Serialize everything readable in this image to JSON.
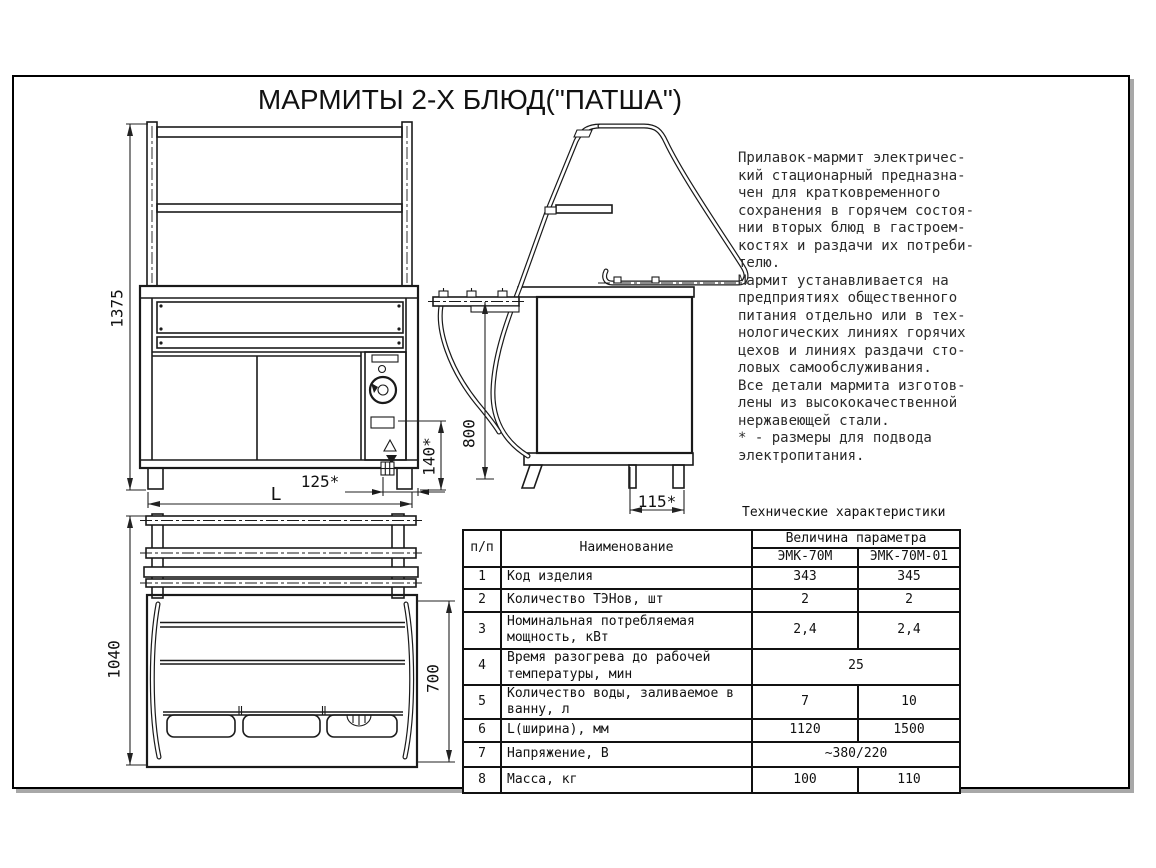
{
  "page": {
    "title": "МАРМИТЫ 2-Х БЛЮД(\"ПАТША\")"
  },
  "colors": {
    "line": "#1a1a1a",
    "frame_shadow": "#a8a8a8",
    "background": "#ffffff"
  },
  "description": {
    "lines": [
      "Прилавок-мармит электричес-",
      "кий стационарный предназна-",
      "чен  для  кратковременного",
      "сохранения в горячем состоя-",
      "нии вторых блюд  в гастроем-",
      "костях и раздачи их  потреби-",
      "телю.",
      "Мармит устанавливается  на",
      "предприятиях общественного",
      "питания отдельно или  в  тех-",
      "нологических линиях горячих",
      "цехов  и  линиях  раздачи сто-",
      "ловых самообслуживания.",
      "Все детали  мармита  изготов-",
      "лены из высококачественной",
      "нержавеющей стали.",
      "* - размеры для подвода",
      "электропитания."
    ]
  },
  "dims": {
    "front_height": "1375",
    "front_width": "L",
    "elec_offset": "125*",
    "elec_height": "140*",
    "side_height": "800",
    "side_offset": "115*",
    "top_depth": "1040",
    "top_inner_depth": "700"
  },
  "table": {
    "title": "Технические характеристики",
    "headers": {
      "num": "п/п",
      "name": "Наименование",
      "value_group": "Величина параметра",
      "model1": "ЭМК-70М",
      "model2": "ЭМК-70М-01"
    },
    "rows": [
      {
        "num": "1",
        "name": "Код изделия",
        "v1": "343",
        "v2": "345"
      },
      {
        "num": "2",
        "name": "Количество ТЭНов, шт",
        "v1": "2",
        "v2": "2"
      },
      {
        "num": "3",
        "name": "Номинальная потребляемая мощность, кВт",
        "v1": "2,4",
        "v2": "2,4"
      },
      {
        "num": "4",
        "name": "Время разогрева до рабочей температуры, мин",
        "merged": "25"
      },
      {
        "num": "5",
        "name": "Количество воды, заливаемое в ванну, л",
        "v1": "7",
        "v2": "10"
      },
      {
        "num": "6",
        "name": "L(ширина), мм",
        "v1": "1120",
        "v2": "1500"
      },
      {
        "num": "7",
        "name": "Напряжение, В",
        "merged": "~380/220"
      },
      {
        "num": "8",
        "name": "Масса, кг",
        "v1": "100",
        "v2": "110"
      }
    ]
  }
}
